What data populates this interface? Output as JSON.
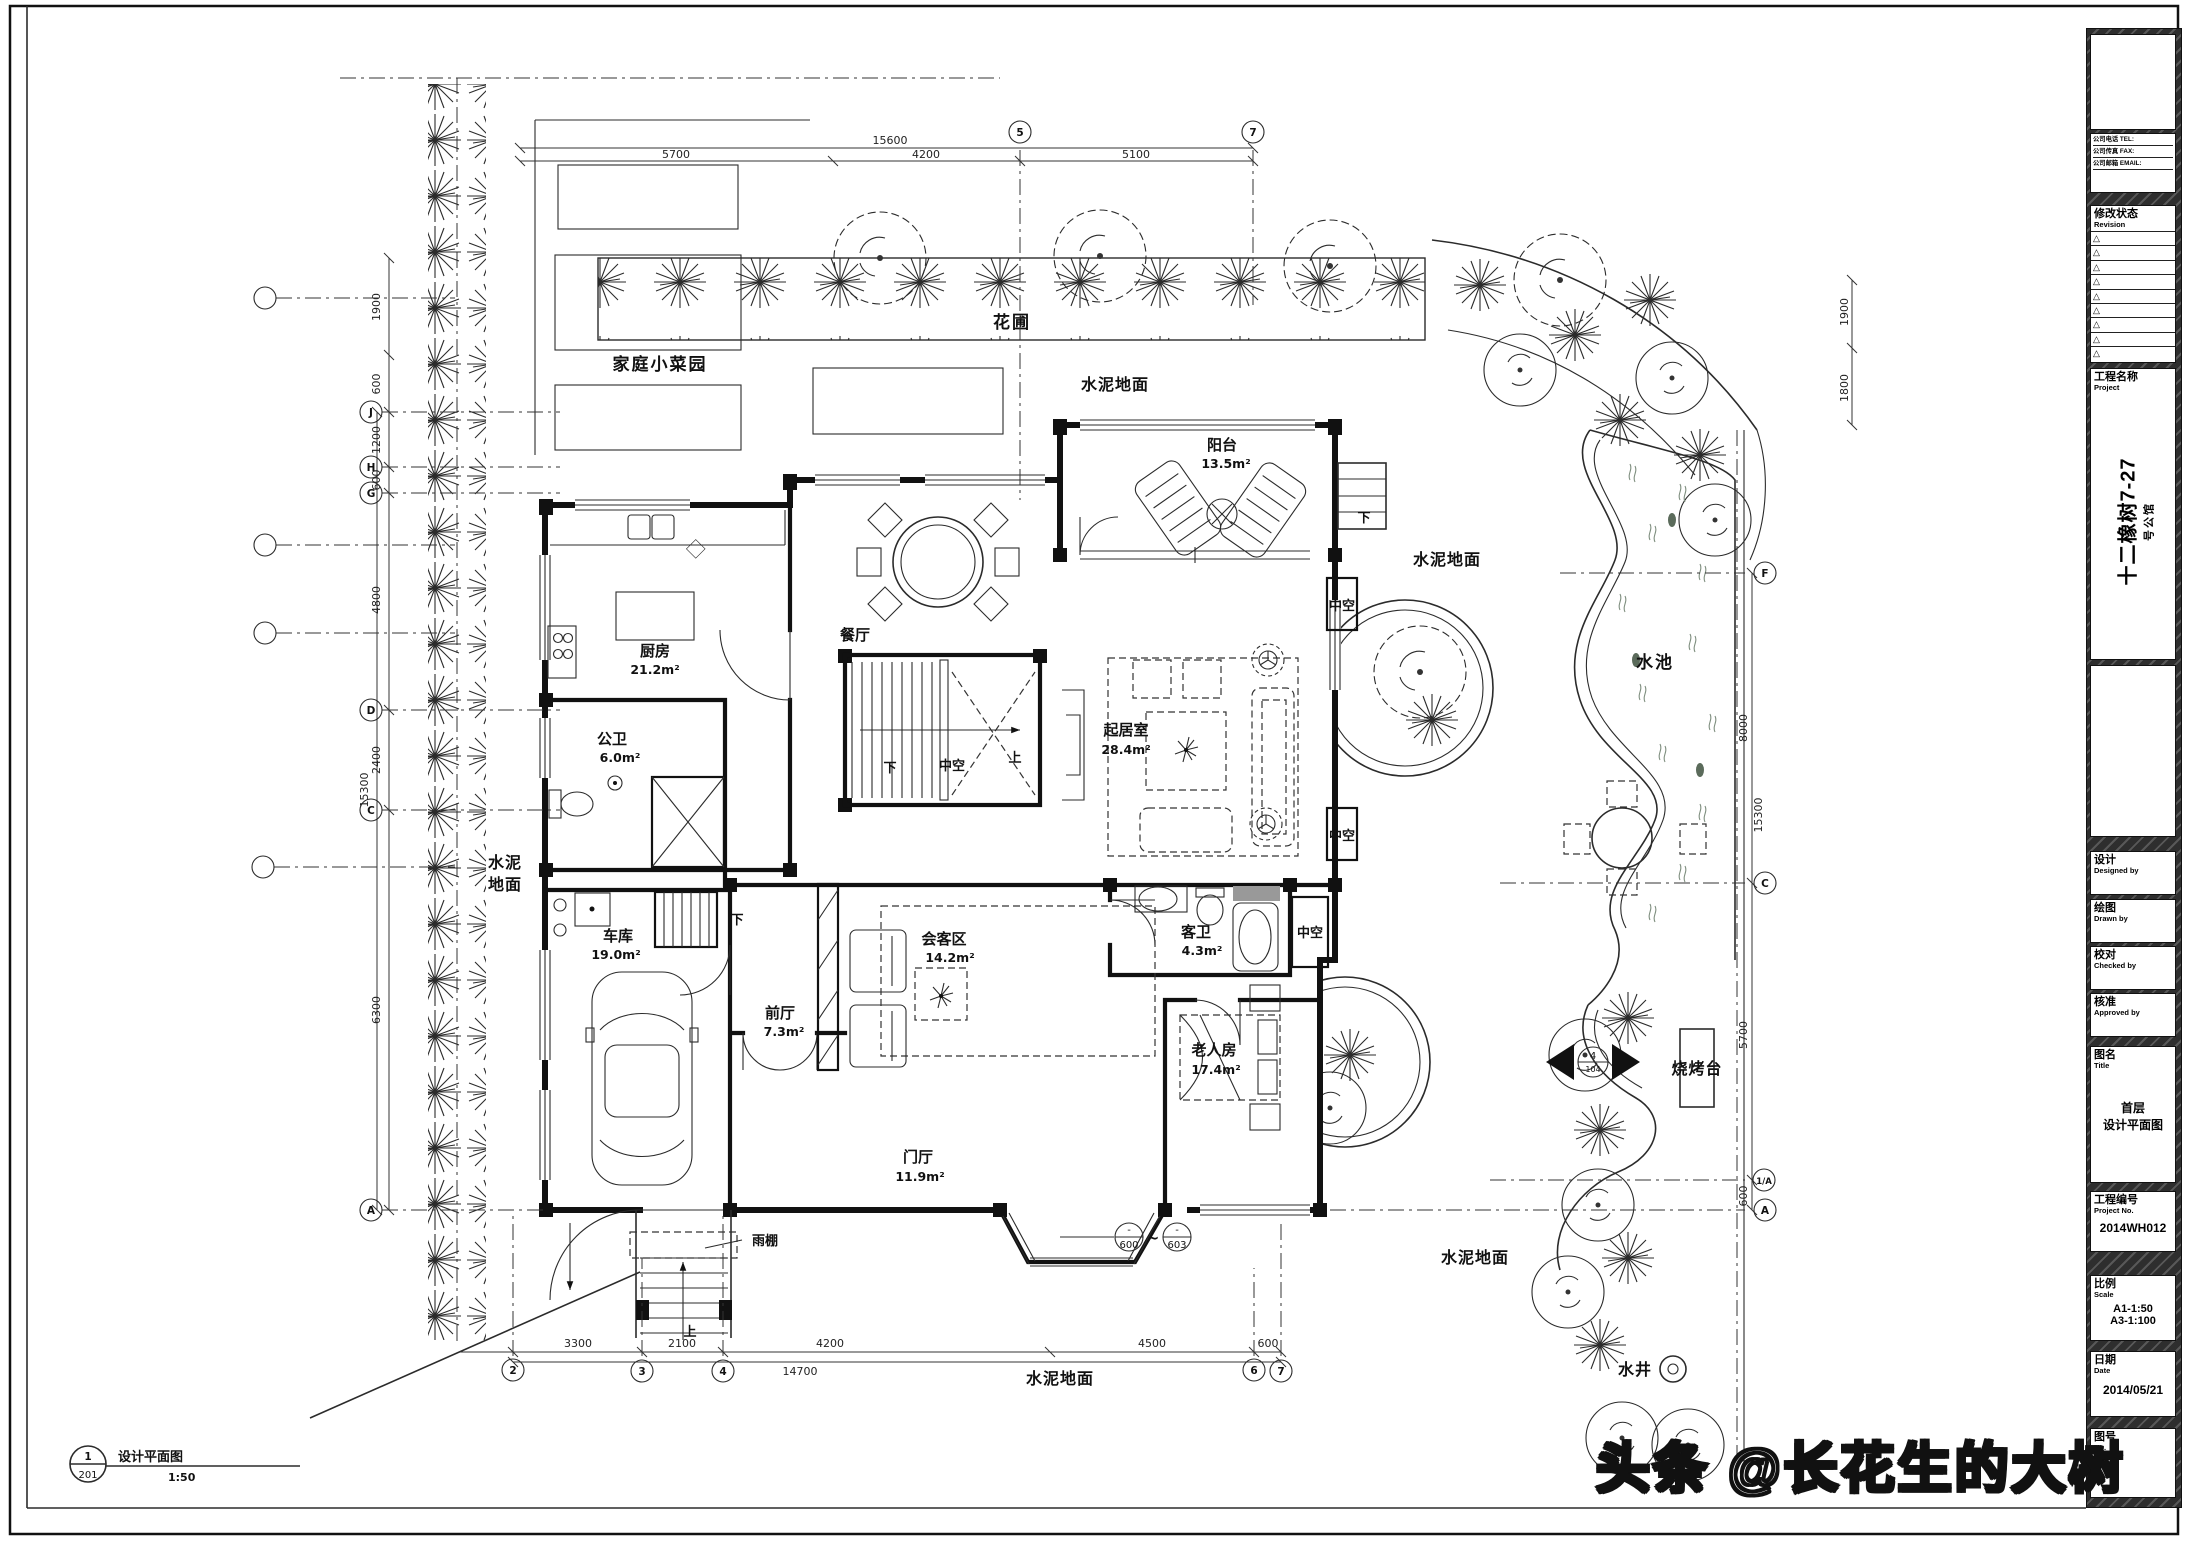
{
  "watermark": "头条 @长花生的大树",
  "title_block": {
    "contact": {
      "tel": "公司电话 TEL:",
      "fax": "公司传真 FAX:",
      "email": "公司邮箱 EMAIL:"
    },
    "revision": {
      "cn": "修改状态",
      "en": "Revision"
    },
    "project": {
      "cn": "工程名称",
      "en": "Project",
      "name": "十二橡树7-27",
      "subtitle": "号公馆"
    },
    "designed": {
      "cn": "设计",
      "en": "Designed by"
    },
    "drawn": {
      "cn": "绘图",
      "en": "Drawn by"
    },
    "checked": {
      "cn": "校对",
      "en": "Checked by"
    },
    "approved": {
      "cn": "核准",
      "en": "Approved by"
    },
    "sheet_title": {
      "cn": "图名",
      "en": "Title",
      "line1": "首层",
      "line2": "设计平面图"
    },
    "project_no": {
      "cn": "工程编号",
      "en": "Project No.",
      "value": "2014WH012"
    },
    "scale": {
      "cn": "比例",
      "en": "Scale",
      "line1": "A1-1:50",
      "line2": "A3-1:100"
    },
    "date": {
      "cn": "日期",
      "en": "Date",
      "value": "2014/05/21"
    },
    "sheet_no": {
      "cn": "图号",
      "en": "No."
    }
  },
  "view_title": {
    "num": "1",
    "sheet": "201",
    "name": "设计平面图",
    "scale": "1:50"
  },
  "rooms": {
    "kitchen": {
      "name": "厨房",
      "area": "21.2m²"
    },
    "public_bath": {
      "name": "公卫",
      "area": "6.0m²"
    },
    "dining": {
      "name": "餐厅"
    },
    "balcony": {
      "name": "阳台",
      "area": "13.5m²"
    },
    "living": {
      "name": "起居室",
      "area": "28.4m²"
    },
    "garage": {
      "name": "车库",
      "area": "19.0m²"
    },
    "front_hall": {
      "name": "前厅",
      "area": "7.3m²"
    },
    "reception": {
      "name": "会客区",
      "area": "14.2m²"
    },
    "foyer": {
      "name": "门厅",
      "area": "11.9m²"
    },
    "guest_bath": {
      "name": "客卫",
      "area": "4.3m²"
    },
    "elder_room": {
      "name": "老人房",
      "area": "17.4m²"
    }
  },
  "labels": {
    "void": "中空",
    "up": "上",
    "down": "下",
    "canopy": "雨棚",
    "veg_garden": "家庭小菜园",
    "flower_bed": "花圃",
    "cement": "水泥地面",
    "cement_l1": "水泥",
    "cement_l2": "地面",
    "pond": "水池",
    "bbq": "烧烤台",
    "well": "水井"
  },
  "grid": {
    "left": [
      "J",
      "H",
      "G",
      "D",
      "C",
      "A"
    ],
    "top": [
      "5",
      "7"
    ],
    "bottom": [
      "2",
      "3",
      "4",
      "6",
      "7"
    ],
    "right": [
      "F",
      "C",
      "1/A",
      "A"
    ]
  },
  "dims": {
    "left": {
      "d1": "1900",
      "d2": "600",
      "d3": "1200",
      "d4": "600",
      "d5": "4800",
      "d6": "2400",
      "d7": "6300",
      "total": "15300"
    },
    "top": {
      "total": "15600",
      "d1": "5700",
      "d2": "4200",
      "d3": "5100"
    },
    "bottom": {
      "d1": "3300",
      "d2": "2100",
      "d3": "4200",
      "d4": "4500",
      "d5": "600",
      "total": "14700"
    },
    "right": {
      "d1": "1900",
      "d2": "1800",
      "d3": "8000",
      "d4": "5700",
      "d5": "600",
      "total": "15300"
    }
  },
  "markers": {
    "elev1": "600",
    "elev2": "603",
    "tilde": "~",
    "minus": "-",
    "section_top": "4",
    "section_bottom": "104"
  }
}
